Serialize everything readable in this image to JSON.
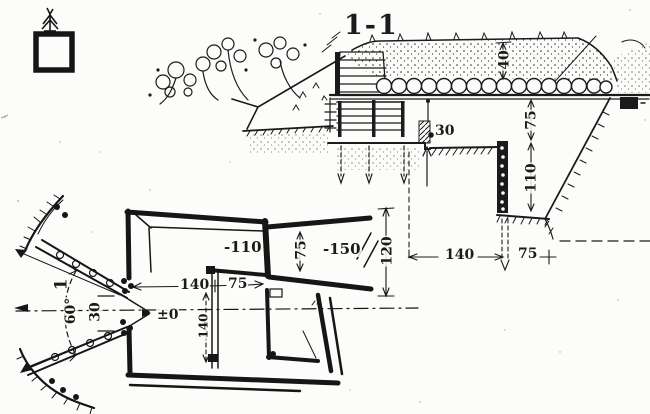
{
  "drawing": {
    "section": {
      "title": "1-1",
      "cover_thickness": "40",
      "height_above_floor": "75",
      "trench_depth": "110",
      "berm_width": "30",
      "floor_width": "140",
      "berm_bottom_width": "75"
    },
    "plan": {
      "room_level": "-110",
      "passage_level": "-150",
      "passage_width": "75",
      "overall_width": "120",
      "entry_level": "±0",
      "entry_length": "140",
      "entry_width": "75",
      "room_depth": "140",
      "embrasure_throat": "30",
      "embrasure_angle": "60°",
      "section_mark": "1"
    }
  }
}
